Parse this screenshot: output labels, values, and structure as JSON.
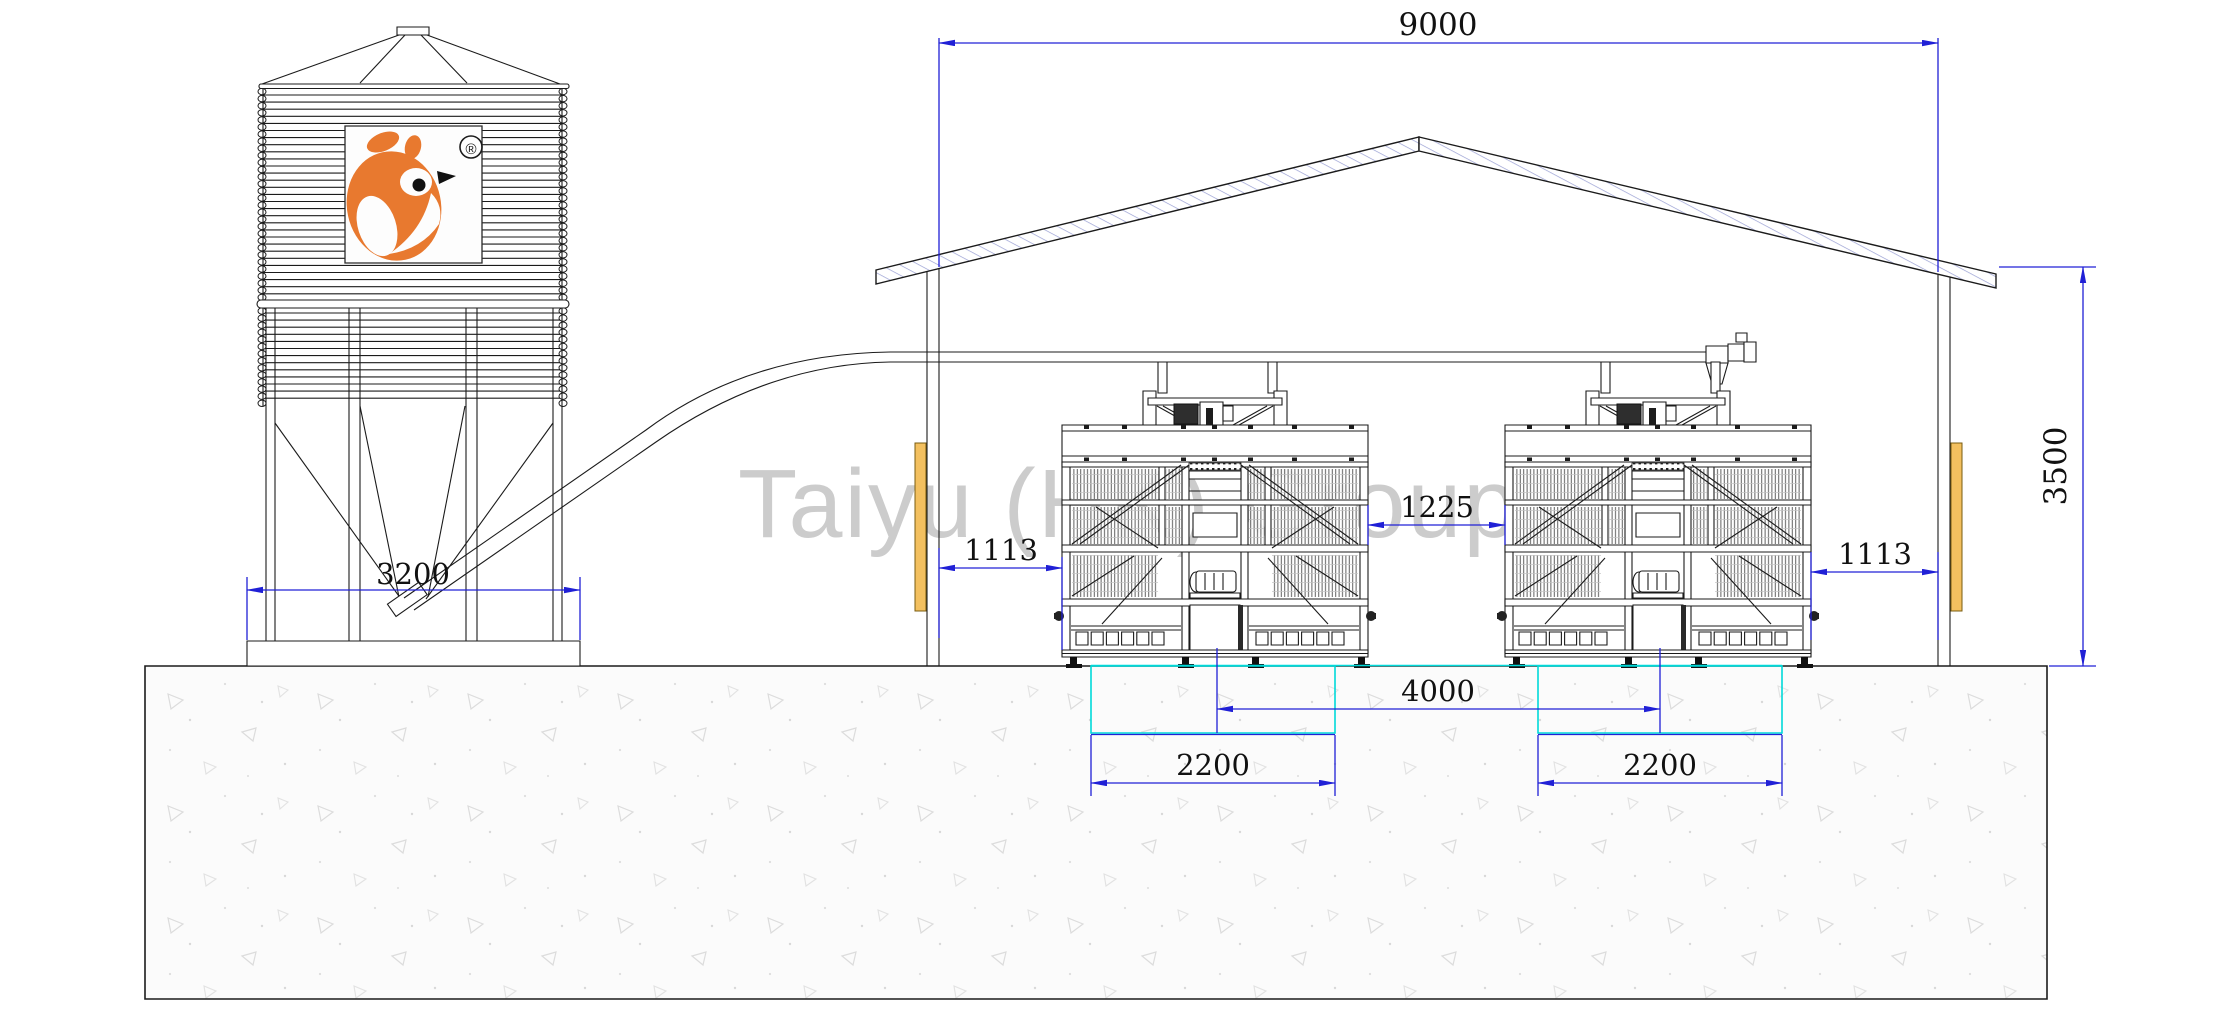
{
  "title": "Poultry house cross-section drawing",
  "watermark": {
    "text": "Taiyu (HK) Group"
  },
  "logo": {
    "registered_mark": "®"
  },
  "colors": {
    "dimension_blue": "#2020d6",
    "pit_cyan": "#00d9d9",
    "brand_orange": "#e8792f",
    "curtain_orange": "#f3c05f",
    "watermark_gray": "#c8c8c8"
  },
  "dimensions": {
    "building_interior_width": {
      "label": "9000"
    },
    "wall_height": {
      "label": "3500"
    },
    "silo_base_width": {
      "label": "3200"
    },
    "left_wall_to_cage_gap": {
      "label": "1113"
    },
    "between_cages_gap": {
      "label": "1225"
    },
    "cage_to_right_wall_gap": {
      "label": "1113"
    },
    "cage_center_spacing": {
      "label": "4000"
    },
    "left_cage_width": {
      "label": "2200"
    },
    "right_cage_width": {
      "label": "2200"
    }
  }
}
